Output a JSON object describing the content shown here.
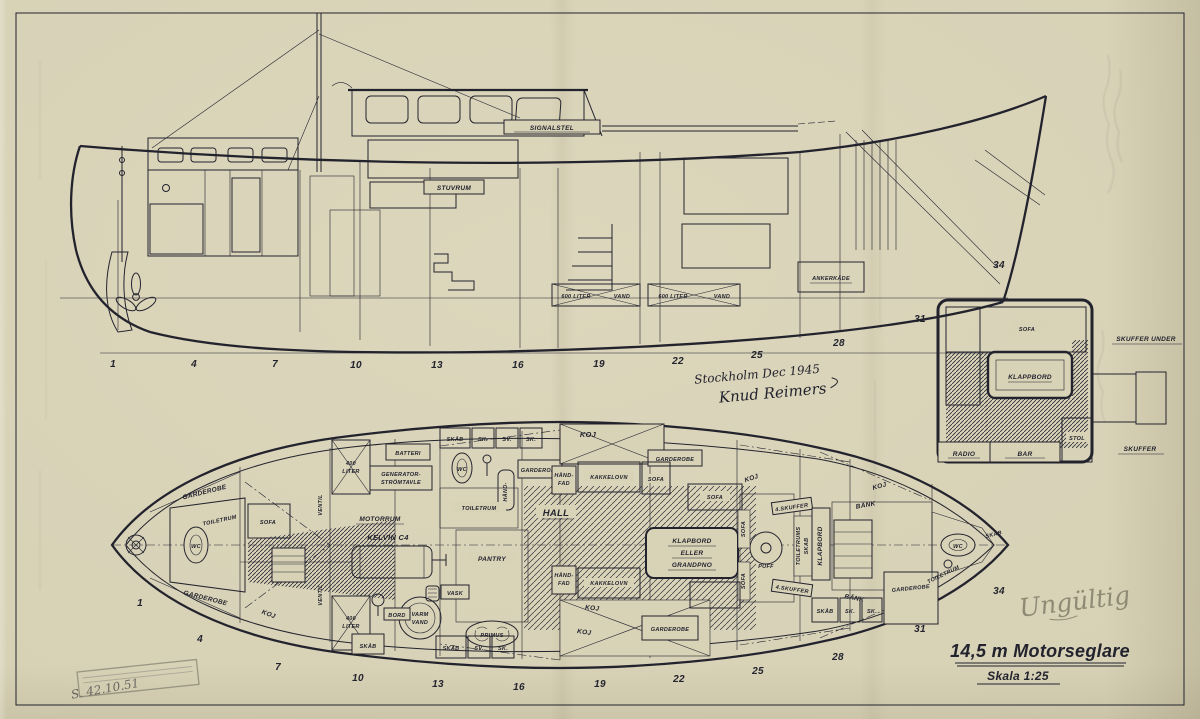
{
  "colors": {
    "paper": "#d8d2b7",
    "ink": "#23232e",
    "pencil": "#8e8a74"
  },
  "title_block": {
    "title": "14,5 m Motorseglare",
    "scale": "Skala 1:25"
  },
  "annotations": {
    "place_date": "Stockholm Dec 1945",
    "signature": "Knud Reimers",
    "pencil_note": "Ungültig",
    "archive_number": "S. 42.10.51"
  },
  "stations": [
    "1",
    "4",
    "7",
    "10",
    "13",
    "16",
    "19",
    "22",
    "25",
    "28",
    "31",
    "34"
  ],
  "side_view": {
    "labels": {
      "signalstel": "SIGNALSTEL",
      "stuvrum": "STUVRUM",
      "tank_volume": "600 LITER",
      "tank_content": "VAND",
      "ankerkade": "ANKERKÄDE"
    }
  },
  "inset": {
    "labels": {
      "sofa": "SOFA",
      "klappbord": "KLAPPBORD",
      "skuffer_under": "SKUFFER UNDER",
      "skuffer": "SKUFFER",
      "radio": "RADIO",
      "bar": "BAR",
      "stol": "STOL"
    }
  },
  "plan_view": {
    "labels": {
      "koj": "KOJ",
      "garderobe": "GARDEROBE",
      "toiletrum": "TOILETRUM",
      "wc": "WC",
      "sofa": "SOFA",
      "skaab": "SKÅB",
      "sk": "SK.",
      "sv": "SV.",
      "batteri": "BATTERI",
      "generator_1": "GENERATOR-",
      "generator_2": "STRÖMTAVLE",
      "tank400_1": "400",
      "tank400_2": "LITER",
      "ventil": "VENTIL",
      "motorrum": "MOTORRUM",
      "engine": "KELVIN C4",
      "pantry": "PANTRY",
      "vask": "VASK",
      "varm": "VARM",
      "vand": "VAND",
      "bord": "BORD",
      "primus": "PRIMUS",
      "hall": "HALL",
      "kakkelovn": "KAKKELOVN",
      "haandfad_1": "HÅND-",
      "haandfad_2": "FAD",
      "table_1": "KLAPBORD",
      "table_2": "ELLER",
      "table_3": "GRANDPNO",
      "puff": "PUFF",
      "skuffer4": "4.SKUFFER",
      "toiletrums": "TOILETRUMS",
      "skab": "SKAB",
      "klapbord_v": "KLAPBORD",
      "baenk": "BÄNK"
    }
  }
}
